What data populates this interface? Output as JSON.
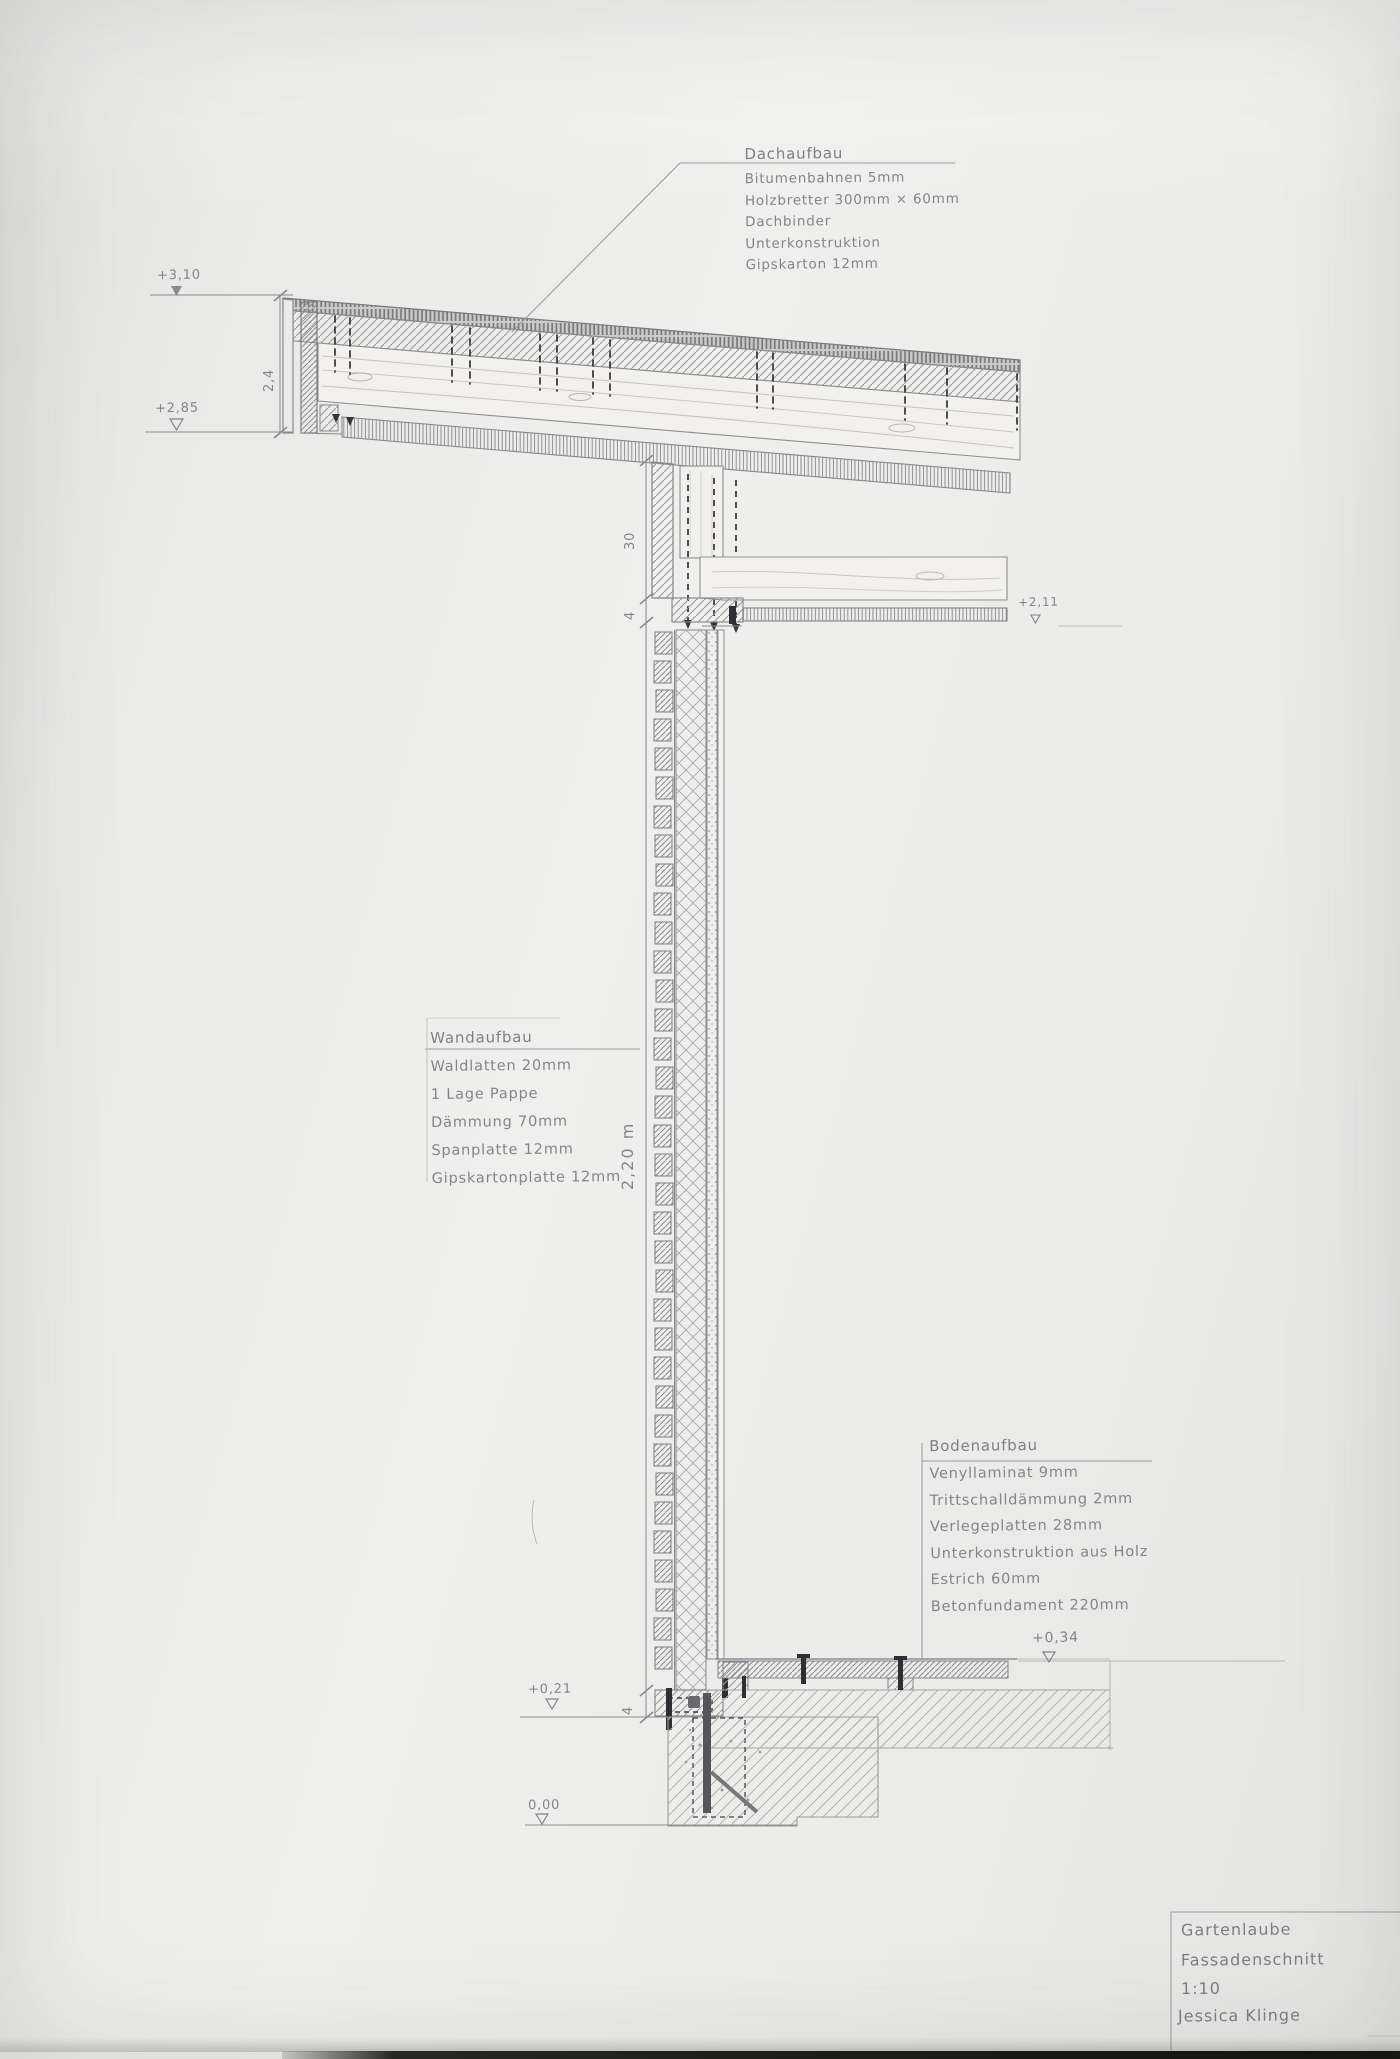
{
  "sheet": {
    "background": "#ebebe9",
    "pencil": "#8a8a8e",
    "dark_accent": "#2f2f33"
  },
  "annotations": {
    "dach": {
      "title": "Dachaufbau",
      "lines": [
        "Bitumenbahnen 5mm",
        "Holzbretter 300mm × 60mm",
        "Dachbinder",
        "Unterkonstruktion",
        "Gipskarton 12mm"
      ]
    },
    "wand": {
      "title": "Wandaufbau",
      "lines": [
        "Waldlatten 20mm",
        "1 Lage Pappe",
        "Dämmung 70mm",
        "Spanplatte 12mm",
        "Gipskartonplatte 12mm"
      ]
    },
    "boden": {
      "title": "Bodenaufbau",
      "lines": [
        "Venyllaminat 9mm",
        "Trittschalldämmung 2mm",
        "Verlegeplatten 28mm",
        "Unterkonstruktion aus Holz",
        "Estrich 60mm",
        "Betonfundament 220mm"
      ]
    }
  },
  "levels": {
    "roof_top": "+3,10",
    "roof_eave": "+2,85",
    "ceiling": "+2,11",
    "floor": "+0,34",
    "plinth": "+0,21",
    "foundation_base": "0,00"
  },
  "dimensions": {
    "roof_edge": "2,4",
    "wall_head": "30",
    "ceiling_pkg": "4",
    "wall_height": "2,20 m",
    "base_plate": "4"
  },
  "titleblock": {
    "project": "Gartenlaube",
    "drawing": "Fassadenschnitt",
    "scale": "1:10",
    "author": "Jessica Klinge"
  }
}
